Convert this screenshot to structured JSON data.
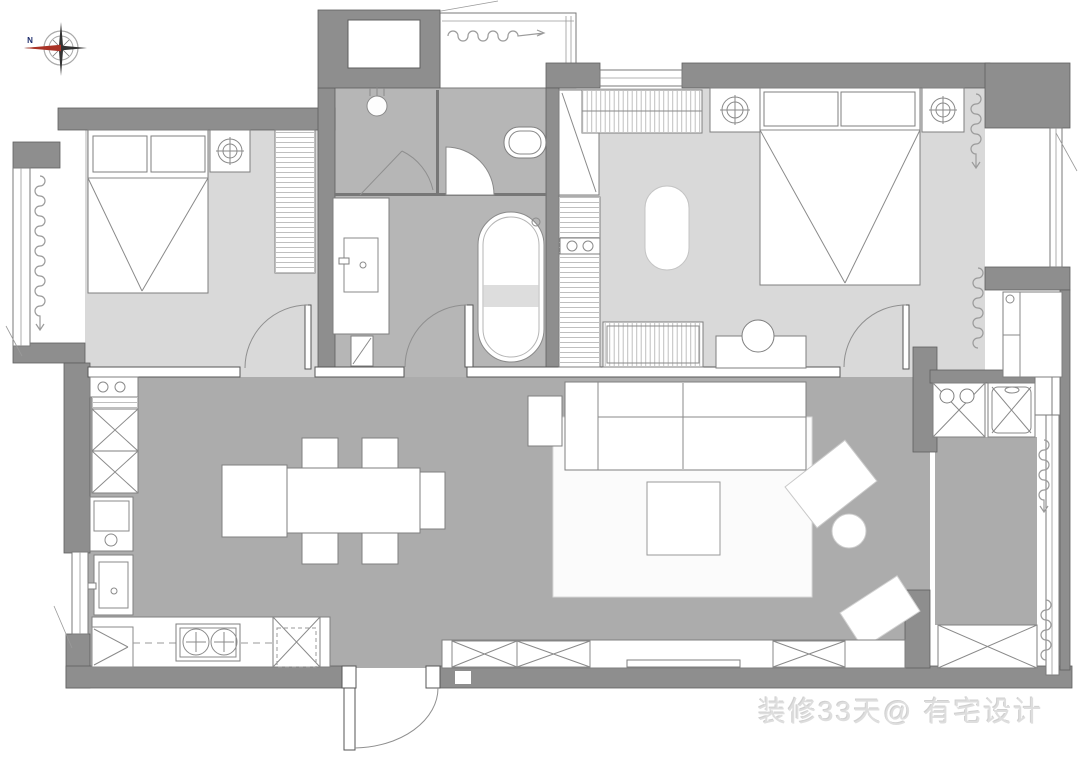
{
  "watermark": {
    "text": "装修33天@ 有宅设计"
  },
  "compass": {
    "north_label": "N"
  },
  "palette": {
    "wall": "#8e8e8e",
    "bedroom_floor": "#d9d9d9",
    "bathroom_floor": "#b6b6b6",
    "living_floor": "#acacac",
    "furniture_outline": "#7f7f7f",
    "compass_needle": "#a93226",
    "compass_star": "#333333",
    "watermark_color": "#dedede"
  }
}
